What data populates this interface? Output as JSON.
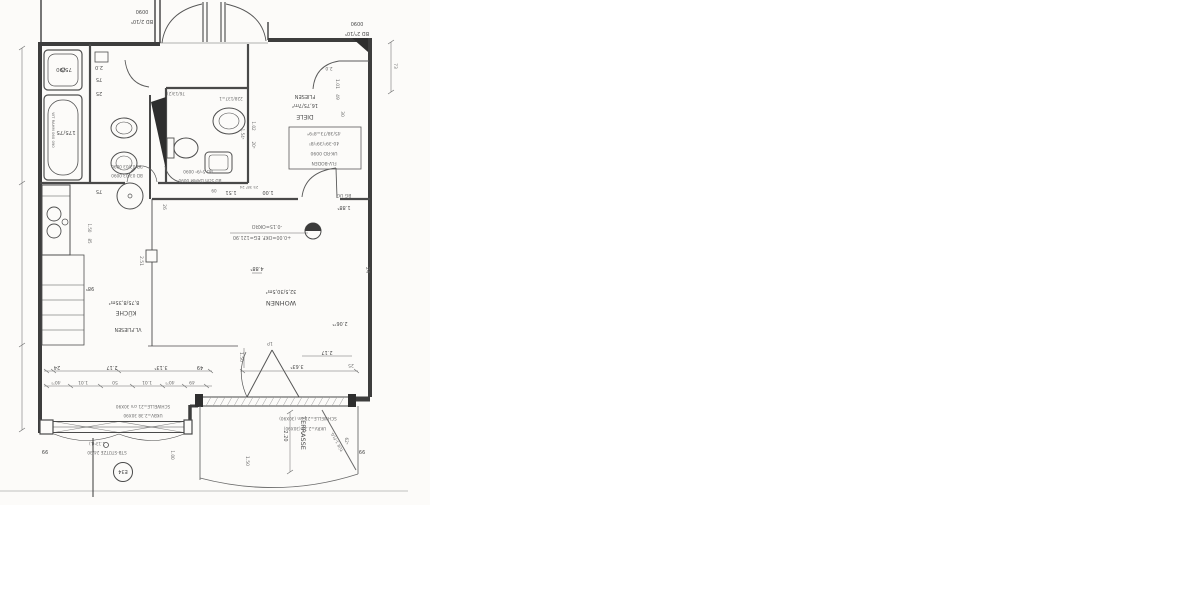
{
  "colors": {
    "paper": "#ffffff",
    "scan_paper": "#fcfbf9",
    "ink": "#474747",
    "ink_dark": "#2e2e2e",
    "faint_line": "#cccccc"
  },
  "rooms": {
    "wohnen": {
      "name": "WOHNEN",
      "area": "32,5/30,5m²"
    },
    "kueche": {
      "name": "KÜCHE",
      "area": "8,75/8,35m²",
      "floor": "VL.FLIESEN"
    },
    "diele": {
      "name": "DIELE",
      "area": "16,75/7m²",
      "floor": "FLIESEN"
    },
    "terrasse": {
      "name": "TERRASSE"
    }
  },
  "fixtures": {
    "tub": "175/75",
    "shower": "75/90"
  },
  "levels": {
    "minus": "-0.15=OKRO",
    "plus": "+0.00=OKF. EG=121.90"
  },
  "notes": {
    "bd_left_l1": "0090",
    "bd_left_l2": "BD 2/10⁵",
    "bd_right_l1": "0090",
    "bd_right_l2": "BD 2⁵/10⁵",
    "bd_a": "BD 03/03 0090",
    "bd_b": "BD 03/03 0090",
    "bd_59": "BD 5⁵/9⁵ 0090",
    "bd_daemm": "BD 5cm DÄMM 0090",
    "diele_d1": "45/38/73=8⁵9⁴",
    "diele_d2": "40-39⁵/39⁵/8⁵",
    "diele_d3": "UK-RD 0090",
    "diele_d4": "FLV-BODEN",
    "schwelle": "SCHWELLE=21 cm 30X90",
    "ukbv": "UKBV=2.38 30X90",
    "schwelle2": "SCHWELLE=21 cm (30X90)",
    "ukrv": "UKRV=2.38 (30X90)",
    "stuetze": "STB-STÜTZE 24/30",
    "stuetze2": "1.13⁵(L)",
    "bg_ug": "BG UG",
    "e34": "E34",
    "tuer": "TÜR 1-FLG.",
    "wc_a": "228/137=1",
    "wc_b": "76/13(2)",
    "wt": "WT RAHM 060 090"
  },
  "dims": {
    "d24": "24",
    "d217": "2.17",
    "d313": "3.13⁵",
    "d49": "49",
    "d4075": "40⁷⁵",
    "d101": "1.01",
    "d50": "50",
    "d151": "1.51",
    "d100": "1.00",
    "d09": "09",
    "dmini": "25 38⁵ 24",
    "d26": "26",
    "d251": "2.51",
    "d985": "98⁵",
    "d75": "75",
    "d150": "1.50",
    "d85": "85",
    "d20": "2.0",
    "d25": "25",
    "d102": "1.02",
    "d205": "20⁵",
    "d1545": "1.54⁵",
    "d1885": "1.88⁵",
    "d4885": "4.88⁵",
    "d220": "2.20",
    "d20675": "2.06⁷⁵",
    "d3635": "3.63⁵",
    "d30": "30",
    "d73": "73",
    "d625": "62⁵",
    "d99": "99",
    "d1p": "1P"
  }
}
